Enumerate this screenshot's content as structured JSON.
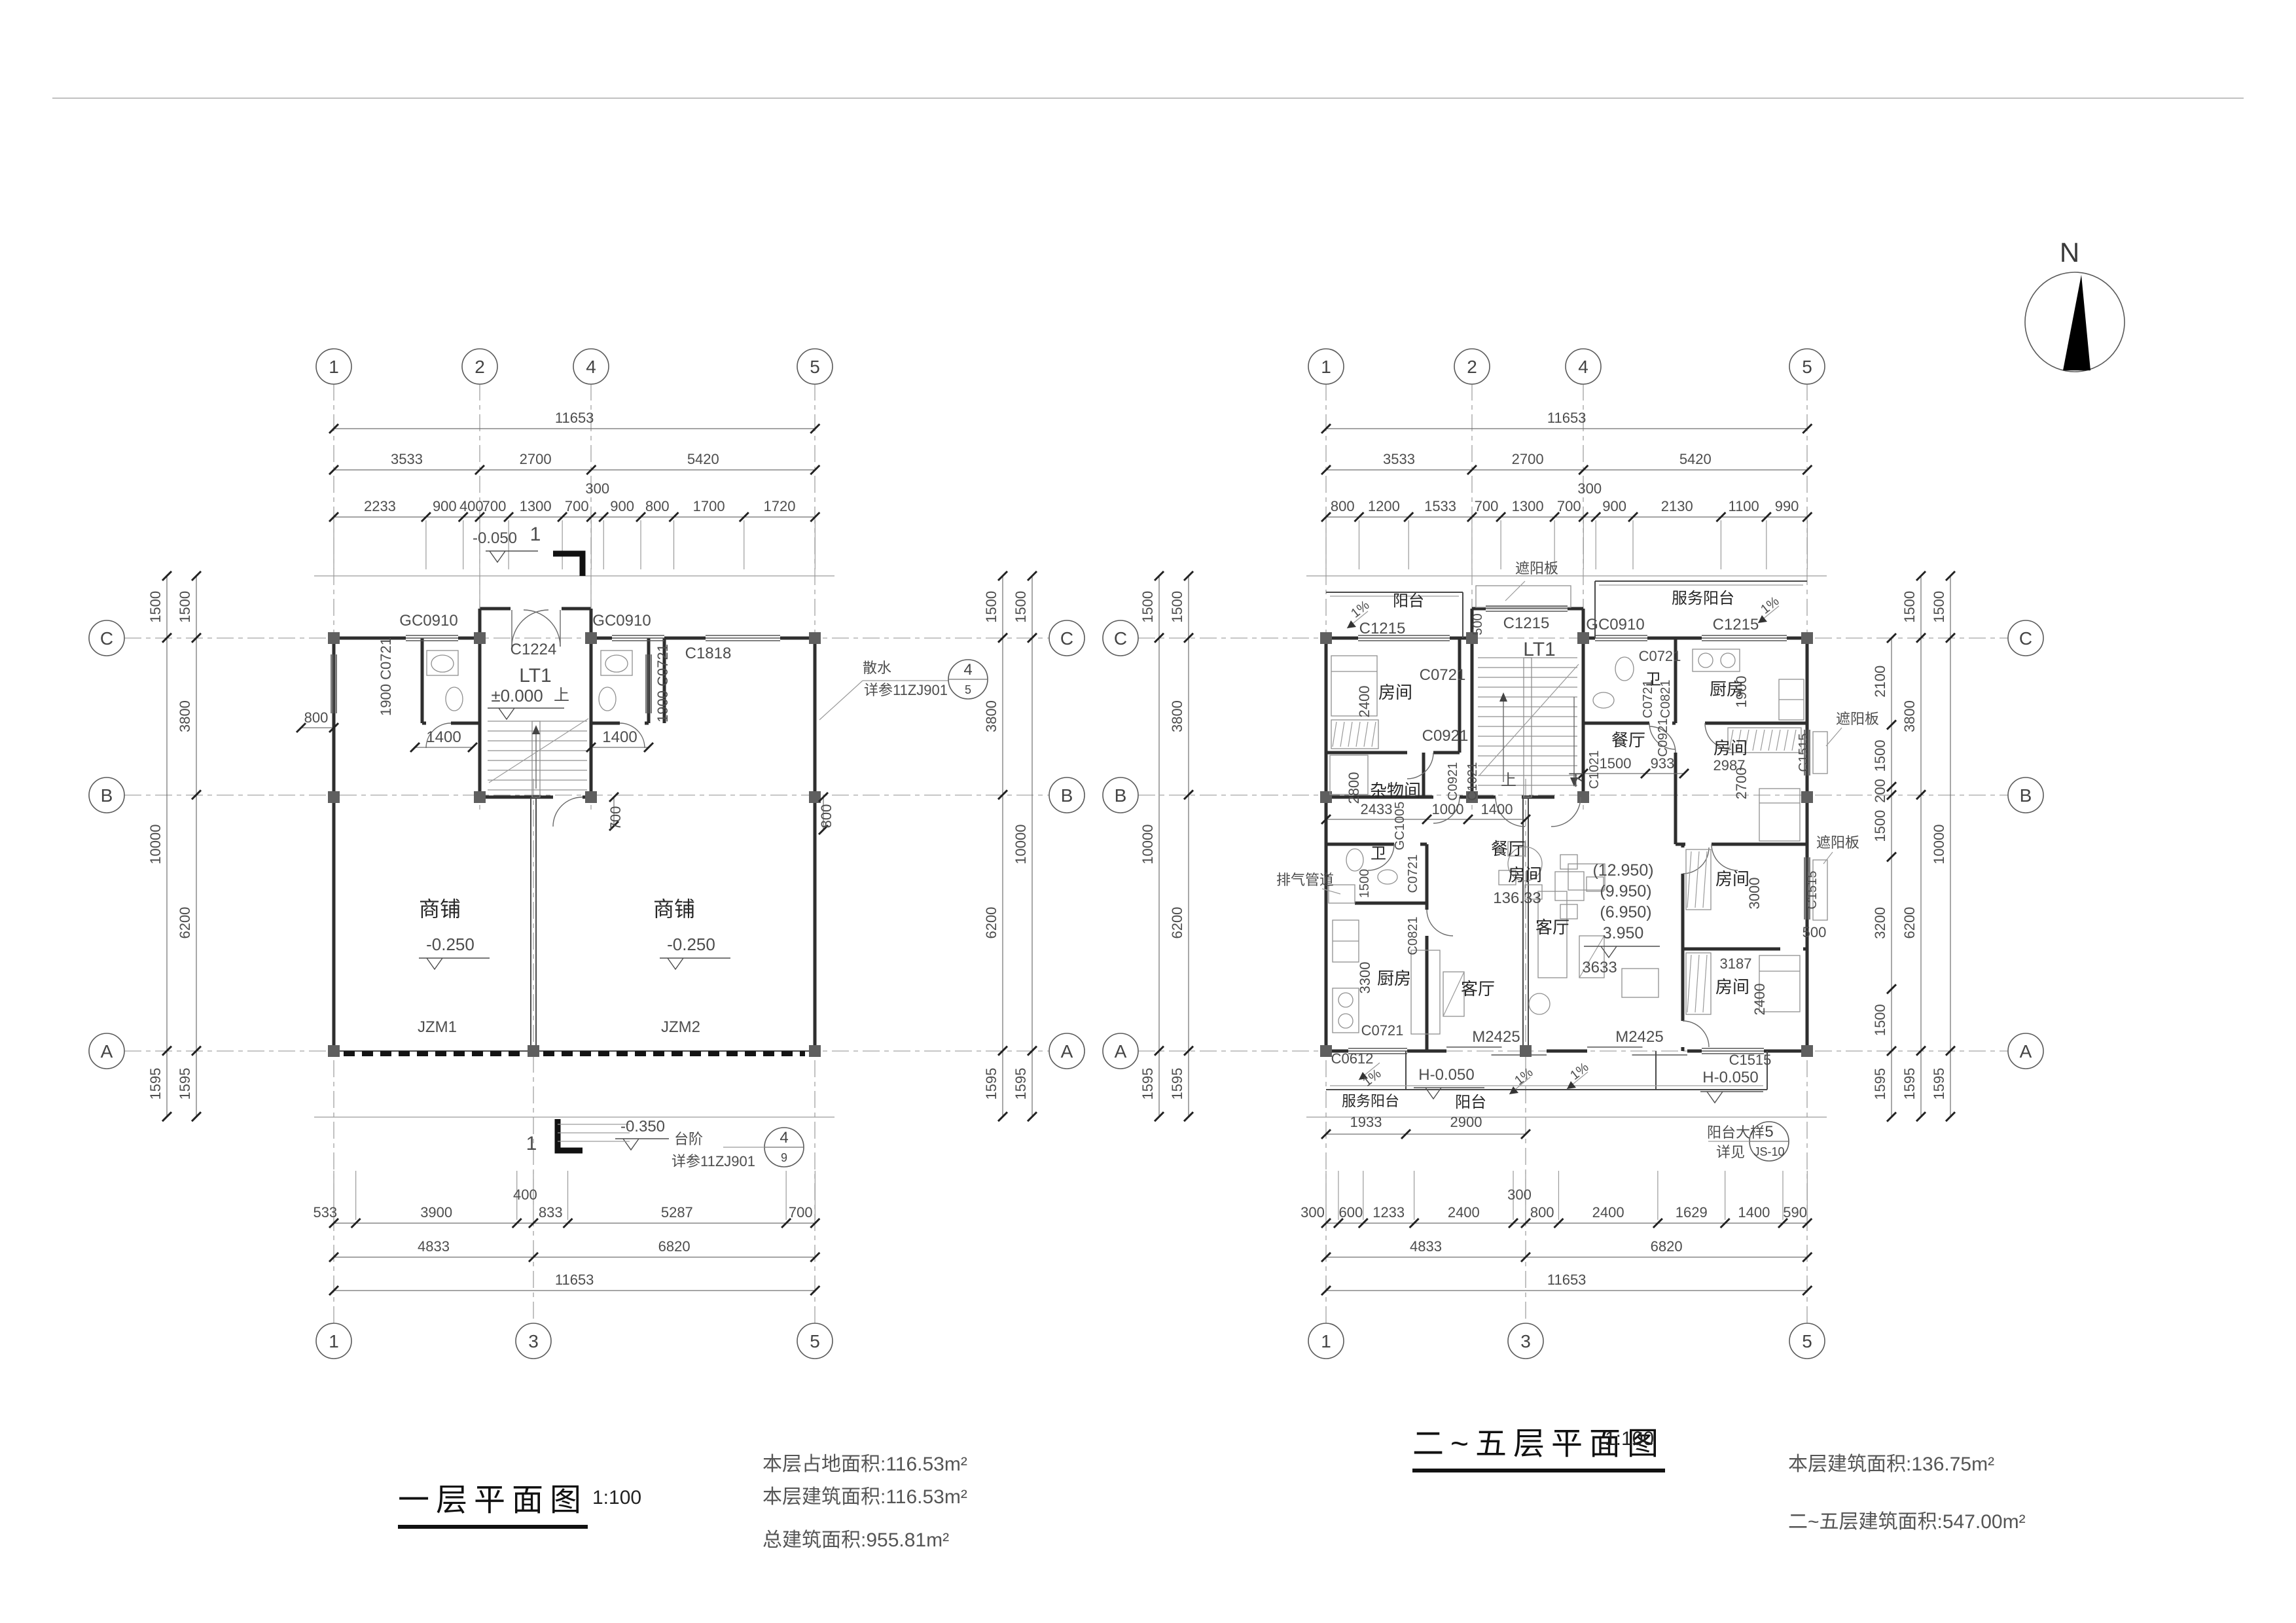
{
  "north": {
    "label": "N"
  },
  "left": {
    "title": "一层平面图",
    "scale": "1:100",
    "notes": [
      "本层占地面积:116.53m²",
      "本层建筑面积:116.53m²",
      "总建筑面积:955.81m²"
    ],
    "axes_top": [
      "1",
      "2",
      "4",
      "5"
    ],
    "axes_bottom": [
      "1",
      "3",
      "5"
    ],
    "axes_side": [
      "C",
      "B",
      "A"
    ],
    "dim_top_total": [
      "11653"
    ],
    "dim_top_major": [
      "3533",
      "2700",
      "5420"
    ],
    "dim_top_minor": [
      "2233",
      "900",
      "400",
      "700",
      "1300",
      "700",
      "300",
      "900",
      "800",
      "1700",
      "1720"
    ],
    "dim_bottom_minor": [
      "533",
      "3900",
      "400",
      "833",
      "5287",
      "700"
    ],
    "dim_bottom_major": [
      "4833",
      "6820"
    ],
    "dim_bottom_total": [
      "11653"
    ],
    "dim_left_outer": [
      "1500",
      "10000",
      "1595"
    ],
    "dim_left_inner": [
      "1500",
      "3800",
      "6200",
      "1595"
    ],
    "dim_right_inner": [
      "1500",
      "3800",
      "6200",
      "1595"
    ],
    "dim_right_outer": [
      "1500",
      "10000",
      "1595"
    ],
    "labels": [
      "GC0910",
      "C1224",
      "GC0910",
      "C1818",
      "LT1",
      "±0.000",
      "上",
      "1900 C0721",
      "1900 C0721",
      "1400",
      "1400",
      "700",
      "800",
      "800",
      "商铺",
      "-0.250",
      "商铺",
      "-0.250",
      "JZM1",
      "JZM2",
      "-0.050",
      "1",
      "-0.350",
      "台阶",
      "详参11ZJ901",
      "1",
      "散水",
      "详参11ZJ901"
    ],
    "details": [
      {
        "no": "4",
        "sheet": "5"
      },
      {
        "no": "4",
        "sheet": "9"
      }
    ]
  },
  "right": {
    "title": "二~五层平面图",
    "scale": "1:100",
    "notes": [
      "本层建筑面积:136.75m²",
      "二~五层建筑面积:547.00m²"
    ],
    "axes_top": [
      "1",
      "2",
      "4",
      "5"
    ],
    "axes_bottom": [
      "1",
      "3",
      "5"
    ],
    "axes_side": [
      "C",
      "B",
      "A"
    ],
    "dim_top_total": [
      "11653"
    ],
    "dim_top_major": [
      "3533",
      "2700",
      "5420"
    ],
    "dim_top_minor": [
      "800",
      "1200",
      "1533",
      "700",
      "1300",
      "700",
      "300",
      "900",
      "2130",
      "1100",
      "990"
    ],
    "dim_bottom_minor": [
      "300",
      "600",
      "1233",
      "2400",
      "300",
      "800",
      "2400",
      "1629",
      "1400",
      "590"
    ],
    "dim_bottom_major": [
      "4833",
      "6820"
    ],
    "dim_bottom_total": [
      "11653"
    ],
    "dim_left_outer": [
      "1500",
      "10000",
      "1595"
    ],
    "dim_left_inner": [
      "1500",
      "3800",
      "6200",
      "1595"
    ],
    "dim_right_inner": [
      "2100",
      "1500",
      "200",
      "1500",
      "3200",
      "1500",
      "1595"
    ],
    "dim_right_mid": [
      "1500",
      "3800",
      "6200",
      "1595"
    ],
    "dim_right_outer": [
      "1500",
      "10000",
      "1595"
    ],
    "labels": [
      "阳台",
      "C1215",
      "1%",
      "遮阳板",
      "C1215",
      "500",
      "LT1",
      "服务阳台",
      "1%",
      "GC0910",
      "C1215",
      "C0721",
      "房间",
      "2400",
      "卫",
      "C0721",
      "C0721",
      "C0821",
      "厨房",
      "1900",
      "餐厅",
      "C0921",
      "C0921",
      "C1021",
      "杂物间",
      "2800",
      "上",
      "下",
      "C0921",
      "房间",
      "2987",
      "2700",
      "C1021",
      "1500",
      "933",
      "遮阳板",
      "C1515",
      "2433",
      "1000",
      "1400",
      "GC1005",
      "餐厅",
      "房间",
      "136.33",
      "(12.950)",
      "(9.950)",
      "(6.950)",
      "3.950",
      "客厅",
      "3633",
      "排气管道",
      "卫",
      "1500",
      "C0721",
      "C0821",
      "3300",
      "厨房",
      "客厅",
      "C0721",
      "C0612",
      "1%",
      "M2425",
      "M2425",
      "H-0.050",
      "1%",
      "1%",
      "服务阳台",
      "阳台",
      "1933",
      "2900",
      "房间",
      "3000",
      "C1515",
      "500",
      "遮阳板",
      "3187",
      "房间",
      "2400",
      "C1515",
      "H-0.050",
      "阳台大样",
      "详见"
    ],
    "details": [
      {
        "no": "5",
        "sheet": "JS-10"
      }
    ]
  }
}
